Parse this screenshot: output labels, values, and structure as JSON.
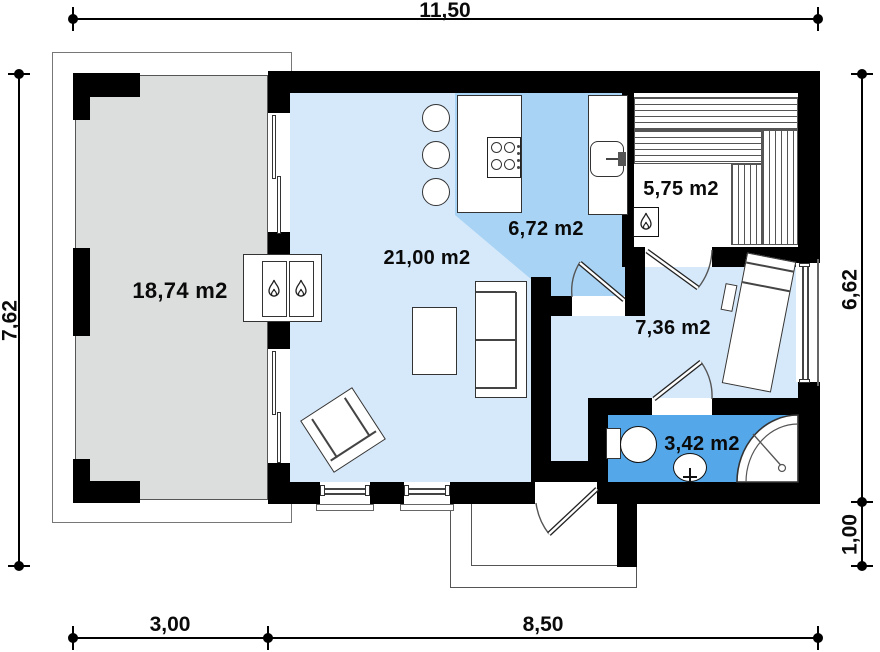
{
  "plan": {
    "rooms": {
      "terrace": {
        "label": "18,74 m2"
      },
      "living_room": {
        "label": "21,00 m2"
      },
      "kitchen": {
        "label": "6,72 m2"
      },
      "sauna": {
        "label": "5,75 m2"
      },
      "bedroom": {
        "label": "7,36 m2"
      },
      "bathroom": {
        "label": "3,42 m2"
      }
    },
    "dimensions": {
      "top_width": "11,50",
      "left_height": "7,62",
      "right_height_upper": "6,62",
      "right_height_lower": "1,00",
      "bottom_left_width": "3,00",
      "bottom_right_width": "8,50"
    },
    "colors": {
      "wall": "#000000",
      "terrace_floor": "#dcdddd",
      "living_floor": "#d6e9fb",
      "kitchen_floor": "#a8d3f4",
      "bathroom_floor": "#54a8ea"
    }
  }
}
